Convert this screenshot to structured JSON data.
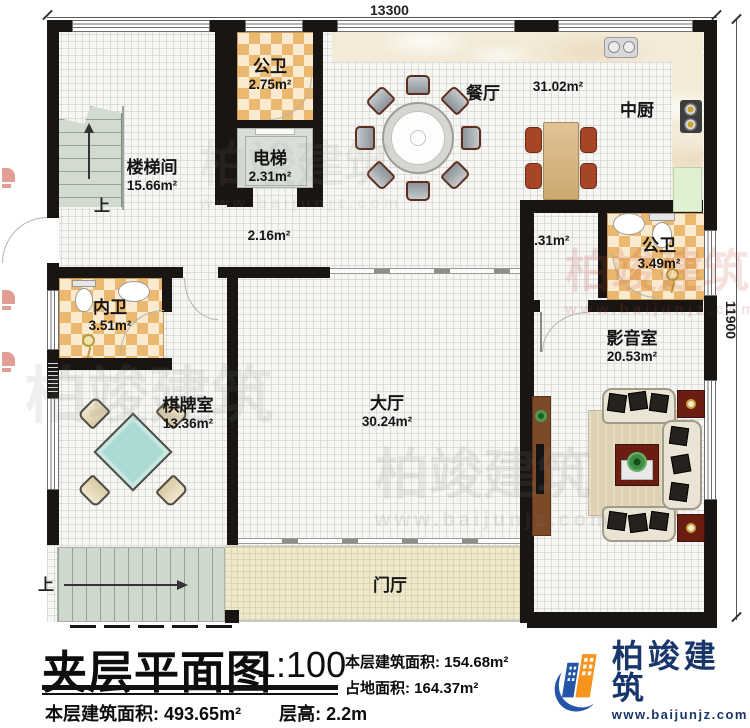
{
  "plan": {
    "dimensions": {
      "top": "13300",
      "right": "11900"
    },
    "rooms": {
      "stairwell": {
        "name": "楼梯间",
        "area": "15.66m²"
      },
      "bath_top": {
        "name": "公卫",
        "area": "2.75m²"
      },
      "elevator": {
        "name": "电梯",
        "area": "2.31m²"
      },
      "dining": {
        "name": "餐厅",
        "area": "31.02m²"
      },
      "kitchen": {
        "name": "中厨"
      },
      "bath_right": {
        "name": "公卫",
        "area": "3.49m²"
      },
      "bath_inner": {
        "name": "内卫",
        "area": "3.51m²"
      },
      "chess_room": {
        "name": "棋牌室",
        "area": "13.36m²"
      },
      "hall": {
        "name": "大厅",
        "area": "30.24m²"
      },
      "media_room": {
        "name": "影音室",
        "area": "20.53m²"
      },
      "foyer": {
        "name": "门厅"
      },
      "corridor_left": {
        "area": "2.16m²"
      },
      "corridor_right": {
        "area": "2.31m²"
      }
    },
    "stairs": {
      "up_top": "上",
      "up_bottom": "上"
    }
  },
  "title_block": {
    "title": "夹层平面图",
    "scale": "1:100",
    "stats_right": [
      {
        "label": "本层建筑面积:",
        "value": "154.68m²"
      },
      {
        "label": "占地面积:",
        "value": "164.37m²"
      }
    ],
    "stats_bottom": [
      {
        "label": "本层建筑面积:",
        "value": "493.65m²"
      },
      {
        "label": "层高:",
        "value": "2.2m"
      }
    ]
  },
  "branding": {
    "logo_text": "柏竣建筑",
    "website": "www.baijunjz.com"
  },
  "watermark": {
    "text": "柏竣建筑",
    "subtext": "www.baijunjz.com"
  },
  "colors": {
    "wall": "#181512",
    "tile": "#eab96f",
    "tile_light": "#f9ead0",
    "logo_blue": "#2456a8",
    "logo_orange": "#f7941d",
    "logo_text": "#19366b"
  }
}
